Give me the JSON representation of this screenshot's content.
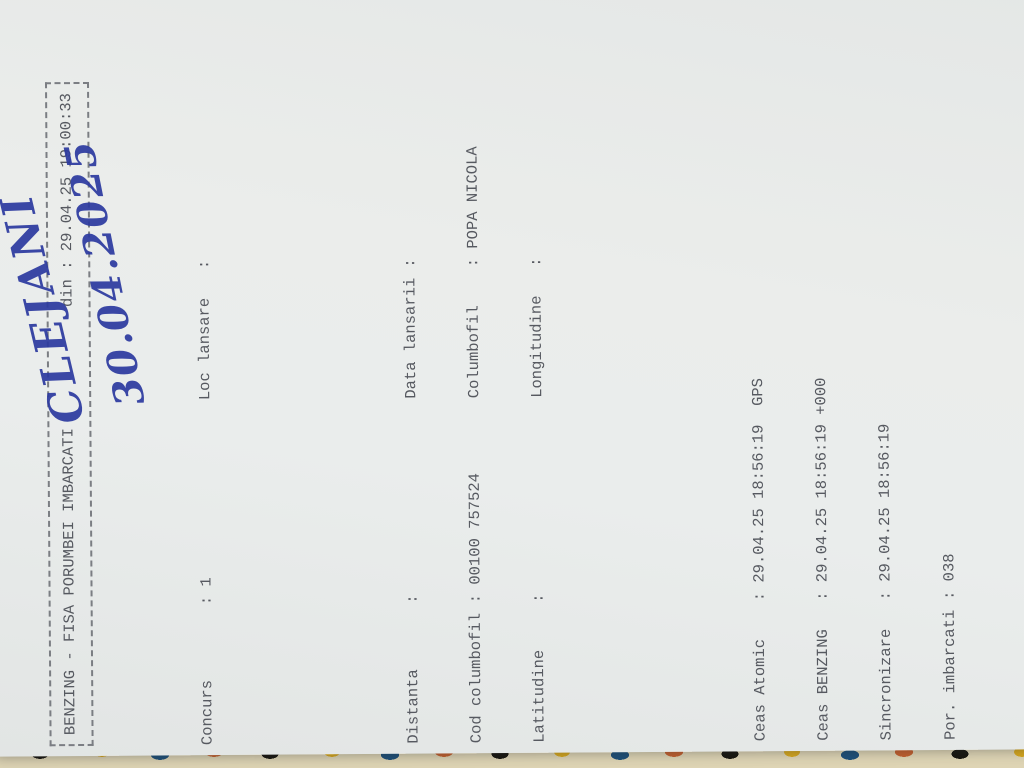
{
  "colors": {
    "paper": "#e9ebea",
    "ink": "#565960",
    "background": "#b7bab8",
    "handwriting_ink": "#2c3aa0",
    "fabric_palette": [
      "#ded4b4",
      "#b5332a",
      "#2a6e63",
      "#d8a81e",
      "#17150f",
      "#c4602e",
      "#1d4f79"
    ]
  },
  "title_box": {
    "left": "BENZING - FISA PORUMBEI IMBARCATI",
    "right": "din : 29.04.25 19:00:33"
  },
  "info": {
    "row0": {
      "ll": "Concurs",
      "lv": ": 1",
      "rl": "Loc lansare",
      "rv": ":"
    },
    "rows": [
      {
        "ll": "Distanta",
        "lv": ":",
        "rl": "Data lansarii",
        "rv": ":"
      },
      {
        "ll": "Cod columbofil",
        "lv": ": 00100 757524",
        "rl": "Columbofil",
        "rv": ": POPA NICOLA"
      },
      {
        "ll": "Latitudine",
        "lv": ":",
        "rl": "Longitudine",
        "rv": ":"
      }
    ]
  },
  "handwriting": {
    "location": "CLEJANI",
    "date": "30.04.2025"
  },
  "clock": {
    "rows": [
      {
        "label": "Ceas Atomic",
        "value": ": 29.04.25 18:56:19  GPS"
      },
      {
        "label": "Ceas BENZING",
        "value": ": 29.04.25 18:56:19 +000"
      },
      {
        "label": "Sincronizare",
        "value": ": 29.04.25 18:56:19"
      },
      {
        "label": "Por. imbarcati",
        "value": ": 038"
      }
    ]
  },
  "table": {
    "head": {
      "nr": "Nr.",
      "serie": "Serie inel",
      "culo1": "Culo",
      "culo2": "are",
      "senzor1": "Nr.inel",
      "senzor2": "Senzor",
      "imb1": "Imbarcare",
      "data2": "Data",
      "ora2": "Ora",
      "obs": "Observatii"
    },
    "rows": [
      {
        "nr": "001",
        "country": "RO",
        "year": "24",
        "serie": "401212",
        "sex": "F",
        "color": "APA",
        "senzor": "DA149D23",
        "data": "29.04",
        "ora": "18:56:28",
        "obs": "019"
      },
      {
        "nr": "002",
        "country": "RO",
        "year": "23",
        "serie": "736673",
        "sex": "F",
        "color": "AB",
        "senzor": "DABCDC1C",
        "data": "29.04",
        "ora": "18:56:36",
        "obs": "028"
      },
      {
        "nr": "003",
        "country": "RO",
        "year": "23",
        "serie": "1017049",
        "sex": "F",
        "color": "AB",
        "senzor": "DADEF757",
        "data": "29.04",
        "ora": "18:56:43",
        "obs": "037"
      },
      {
        "nr": "004",
        "country": "RO",
        "year": "24",
        "serie": "401197",
        "sex": "M",
        "color": "AB",
        "senzor": "DAD88BEA",
        "data": "29.04",
        "ora": "18:56:54",
        "obs": "013"
      },
      {
        "nr": "005",
        "country": "RO",
        "year": "23",
        "serie": "736658",
        "sex": "F",
        "color": "AB",
        "senzor": "DA149CE1",
        "data": "29.04",
        "ora": "18:57:00",
        "obs": "026"
      },
      {
        "nr": "006",
        "country": "RO",
        "year": "23",
        "serie": "736682",
        "sex": "F",
        "color": "SZ",
        "senzor": "DA1A0A95",
        "data": "29.04",
        "ora": "18:57:05",
        "obs": "029"
      },
      {
        "nr": "007",
        "country": "RO",
        "year": "24",
        "serie": "804890",
        "sex": "M",
        "color": "AB",
        "senzor": "DA92B6FD",
        "data": "29.04",
        "ora": "18:57:09",
        "obs": "034"
      },
      {
        "nr": "008",
        "country": "RO",
        "year": "24",
        "serie": "401156",
        "sex": "F",
        "color": "SZ",
        "senzor": "DA165578",
        "data": "29.04",
        "ora": "18:57:15",
        "obs": "005"
      },
      {
        "nr": "009",
        "country": "RO",
        "year": "24",
        "serie": "401194",
        "sex": "F",
        "color": "AB",
        "senzor": "DA9416B3",
        "data": "29.04",
        "ora": "18:57:20",
        "obs": "011"
      },
      {
        "nr": "010",
        "country": "RO",
        "year": "23",
        "serie": "736655",
        "sex": "F",
        "color": "SZ",
        "senzor": "DA149D40",
        "data": "29.04",
        "ora": "18:57:24",
        "obs": "025"
      },
      {
        "nr": "011",
        "country": "RO",
        "year": "24",
        "serie": "401187",
        "sex": "M",
        "color": "SZ",
        "senzor": "DA409A10",
        "data": "29.04",
        "ora": "18:57:29",
        "obs": "010"
      },
      {
        "nr": "012",
        "country": "RO",
        "year": "23",
        "serie": "736697",
        "sex": "F",
        "color": "TRES",
        "senzor": "DA96A610",
        "data": "29.04",
        "ora": "18:57:34",
        "obs": "032"
      },
      {
        "nr": "013",
        "country": "RO",
        "year": "24",
        "serie": "401184",
        "sex": "M",
        "color": "SZ",
        "senzor": "DA74428E",
        "data": "29.04",
        "ora": "18:57:39",
        "obs": "009"
      },
      {
        "nr": "014",
        "country": "RO",
        "year": "23",
        "serie": "1017050",
        "sex": "F",
        "color": "SZ",
        "senzor": "DA409C04",
        "data": "29.04",
        "ora": "18:57:45",
        "obs": "038"
      },
      {
        "nr": "015",
        "country": "RO",
        "year": "24",
        "serie": "401196",
        "sex": "M",
        "color": "SZ",
        "senzor": "DA409B9D",
        "data": "29.04",
        "ora": "18:57:51",
        "obs": "012"
      },
      {
        "nr": "016",
        "country": "RO",
        "year": "23",
        "serie": "1017876",
        "sex": "F",
        "color": "SZ",
        "senzor": "DAEF7BBD",
        "data": "29.04",
        "ora": "18:57:57",
        "obs": "039"
      },
      {
        "nr": "017",
        "country": "RO",
        "year": "23",
        "serie": "736688",
        "sex": "M",
        "color": "SZ",
        "senzor": "DA744161",
        "data": "29.04",
        "ora": "18:58:02",
        "obs": "030"
      },
      {
        "nr": "018",
        "country": "RO",
        "year": "23",
        "serie": "736689",
        "sex": "F",
        "color": "SZ",
        "senzor": "DB095831",
        "data": "29.04",
        "ora": "18:58:06",
        "obs": "031"
      },
      {
        "nr": "019",
        "country": "RO",
        "year": "24",
        "serie": "401205",
        "sex": "M",
        "color": "SZ",
        "senzor": "DA326E7D",
        "data": "29.04",
        "ora": "18:58:11",
        "obs": "015"
      },
      {
        "nr": "020",
        "country": "RO",
        "year": "24",
        "serie": "401139",
        "sex": "M",
        "color": "SZ",
        "senzor": "DA5B5FB2",
        "data": "29.04",
        "ora": "18:58:17",
        "obs": "003"
      },
      {
        "nr": "021",
        "country": "RO",
        "year": "24",
        "serie": "401236",
        "sex": "M",
        "color": "SZ",
        "senzor": "DA1D8136",
        "data": "29.04",
        "ora": "18:58:23",
        "obs": "021"
      },
      {
        "nr": "022",
        "country": "RO",
        "year": "24",
        "serie": "402999",
        "sex": "F",
        "color": "SZ",
        "senzor": "DA3C6C18",
        "data": "29.04",
        "ora": "18:58:38",
        "obs": "024"
      },
      {
        "nr": "023",
        "country": "RO",
        "year": "24",
        "serie": "401174",
        "sex": "F",
        "color": "SZ",
        "senzor": "DA409AA7",
        "data": "29.04",
        "ora": "18:58:43",
        "obs": "006"
      },
      {
        "nr": "024",
        "country": "RO",
        "year": "23",
        "serie": "1017001",
        "sex": "F",
        "color": "GPA",
        "senzor": "DAD83470",
        "data": "29.04",
        "ora": "18:58:48",
        "obs": "035"
      },
      {
        "nr": "025",
        "country": "RO",
        "year": "23",
        "serie": "1017032",
        "sex": "F",
        "color": "SZ",
        "senzor": "DA0EB271",
        "data": "29.04",
        "ora": "18:58:53",
        "obs": "036"
      },
      {
        "nr": "026",
        "country": "RO",
        "year": "24",
        "serie": "401182",
        "sex": "F",
        "color": "AB",
        "senzor": "DA409AFD",
        "data": "29.04",
        "ora": "18:58:57",
        "obs": "008"
      },
      {
        "nr": "027",
        "country": "RO",
        "year": "24",
        "serie": "402997",
        "sex": "F",
        "color": "SZ",
        "senzor": "DA1255E0",
        "data": "29.04",
        "ora": "18:59:02",
        "obs": "022"
      },
      {
        "nr": "028",
        "country": "RO",
        "year": "23",
        "serie": "736699",
        "sex": "F",
        "color": "SZ",
        "senzor": "DAF95B5B",
        "data": "29.04",
        "ora": "18:59:06",
        "obs": "033"
      },
      {
        "nr": "029",
        "country": "RO",
        "year": "24",
        "serie": "401213",
        "sex": "F",
        "color": "GUT",
        "senzor": "DAB529AF",
        "data": "29.04",
        "ora": "18:59:11",
        "obs": "020"
      },
      {
        "nr": "030",
        "country": "RO",
        "year": "24",
        "serie": "401104",
        "sex": "F",
        "color": "SZ",
        "senzor": "DAEEF704",
        "data": "29.04",
        "ora": "18:59:17",
        "obs": "001"
      },
      {
        "nr": "031",
        "country": "RO",
        "year": "24",
        "serie": "401211",
        "sex": "F",
        "color": "AB",
        "senzor": "DA08DCC8",
        "data": "29.04",
        "ora": "18:59:22",
        "obs": "018"
      },
      {
        "nr": "032",
        "country": "RO",
        "year": "24",
        "serie": "401208",
        "sex": "F",
        "color": "SZ",
        "senzor": "DA3630B8",
        "data": "29.04",
        "ora": "18:59:29",
        "obs": "016"
      },
      {
        "nr": "033",
        "country": "RO",
        "year": "24",
        "serie": "401176",
        "sex": "M",
        "color": "TRES",
        "senzor": "DA149DA3",
        "data": "29.04",
        "ora": "18:59:33",
        "obs": "007"
      },
      {
        "nr": "034",
        "country": "RO",
        "year": "24",
        "serie": "401210",
        "sex": "M",
        "color": "SZ",
        "senzor": "DACC05C8",
        "data": "29.04",
        "ora": "18:59:38",
        "obs": "017"
      },
      {
        "nr": "035",
        "country": "RO",
        "year": "23",
        "serie": "736661",
        "sex": "F",
        "color": "AB",
        "senzor": "DA409A7B",
        "data": "29.04",
        "ora": "18:59:43",
        "obs": "027"
      }
    ]
  },
  "footer": {
    "brand": "====>  B E N Z I N G   E x p r e s s   G 2  <===="
  }
}
